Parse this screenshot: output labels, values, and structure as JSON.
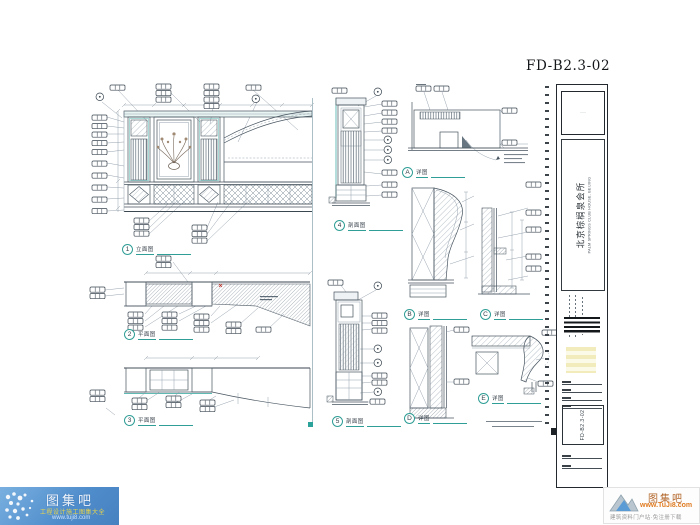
{
  "sheet": {
    "number": "FD-B2.3-02"
  },
  "title_block": {
    "logo_mark": "···",
    "project_name_cn": "北京棕榈泉会所",
    "project_name_en": "PALM SPRINGS CLUB HOUSE, BEIJING",
    "drawing_no": "FD-B2.3-02"
  },
  "details": [
    {
      "id": "1",
      "title": "立面图"
    },
    {
      "id": "2",
      "title": "平面图"
    },
    {
      "id": "3",
      "title": "平面图"
    },
    {
      "id": "4",
      "title": "剖面图"
    },
    {
      "id": "5",
      "title": "剖面图"
    },
    {
      "id": "A",
      "title": "详图"
    },
    {
      "id": "B",
      "title": "详图"
    },
    {
      "id": "C",
      "title": "详图"
    },
    {
      "id": "D",
      "title": "详图"
    },
    {
      "id": "E",
      "title": "详图"
    }
  ],
  "watermarks": {
    "bottom_left": {
      "brand": "图集吧",
      "tagline": "工程设计施工图集大全",
      "url": "www.tuji8.com"
    },
    "bottom_right": {
      "brand": "图集吧",
      "url": "www.TuJi8.com",
      "tagline": "建筑资料门户站·免注册下载"
    }
  }
}
